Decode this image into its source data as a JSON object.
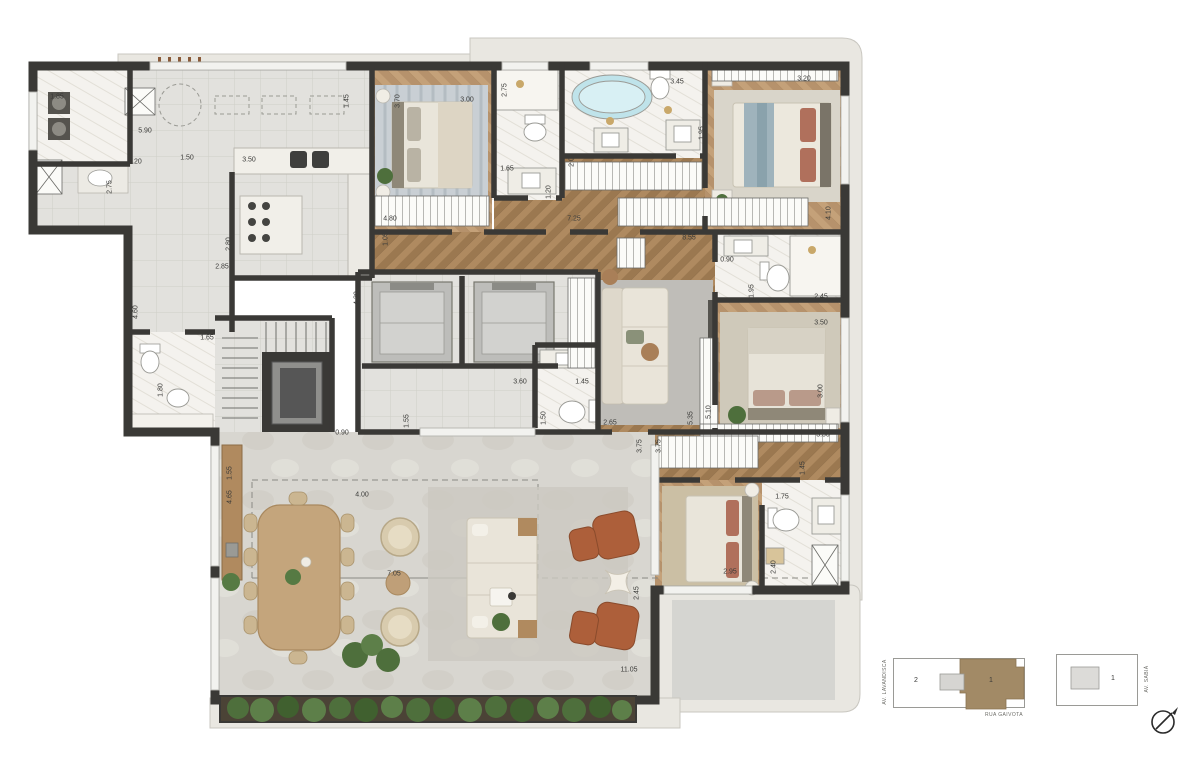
{
  "plan": {
    "dimensions": [
      {
        "x": 57,
        "y": 97,
        "v": "1.85",
        "r": 0
      },
      {
        "x": 145,
        "y": 131,
        "v": "5.90",
        "r": 0
      },
      {
        "x": 347,
        "y": 101,
        "v": "1.45",
        "r": 1
      },
      {
        "x": 135,
        "y": 162,
        "v": "1.20",
        "r": 0
      },
      {
        "x": 187,
        "y": 158,
        "v": "1.50",
        "r": 0
      },
      {
        "x": 249,
        "y": 160,
        "v": "3.50",
        "r": 0
      },
      {
        "x": 110,
        "y": 187,
        "v": "2.75",
        "r": 1
      },
      {
        "x": 229,
        "y": 244,
        "v": "2.80",
        "r": 1
      },
      {
        "x": 398,
        "y": 101,
        "v": "3.70",
        "r": 1
      },
      {
        "x": 467,
        "y": 100,
        "v": "3.00",
        "r": 0
      },
      {
        "x": 505,
        "y": 90,
        "v": "2.75",
        "r": 1
      },
      {
        "x": 677,
        "y": 82,
        "v": "3.45",
        "r": 0
      },
      {
        "x": 702,
        "y": 133,
        "v": "1.95",
        "r": 1
      },
      {
        "x": 507,
        "y": 169,
        "v": "1.65",
        "r": 0
      },
      {
        "x": 572,
        "y": 160,
        "v": "2.00",
        "r": 1
      },
      {
        "x": 549,
        "y": 192,
        "v": "1.20",
        "r": 1
      },
      {
        "x": 574,
        "y": 219,
        "v": "7.25",
        "r": 0
      },
      {
        "x": 390,
        "y": 219,
        "v": "4.80",
        "r": 0
      },
      {
        "x": 386,
        "y": 239,
        "v": "1.05",
        "r": 1
      },
      {
        "x": 689,
        "y": 238,
        "v": "8.55",
        "r": 0
      },
      {
        "x": 804,
        "y": 79,
        "v": "3.20",
        "r": 0
      },
      {
        "x": 829,
        "y": 213,
        "v": "4.10",
        "r": 1
      },
      {
        "x": 727,
        "y": 260,
        "v": "0.90",
        "r": 0
      },
      {
        "x": 752,
        "y": 291,
        "v": "1.95",
        "r": 1
      },
      {
        "x": 821,
        "y": 297,
        "v": "2.45",
        "r": 0
      },
      {
        "x": 821,
        "y": 323,
        "v": "3.50",
        "r": 0
      },
      {
        "x": 821,
        "y": 391,
        "v": "3.00",
        "r": 1
      },
      {
        "x": 709,
        "y": 412,
        "v": "5.10",
        "r": 1
      },
      {
        "x": 691,
        "y": 418,
        "v": "5.35",
        "r": 1
      },
      {
        "x": 823,
        "y": 435,
        "v": "3.50",
        "r": 0
      },
      {
        "x": 520,
        "y": 382,
        "v": "3.60",
        "r": 0
      },
      {
        "x": 582,
        "y": 382,
        "v": "1.45",
        "r": 0
      },
      {
        "x": 407,
        "y": 421,
        "v": "1.55",
        "r": 1
      },
      {
        "x": 544,
        "y": 418,
        "v": "1.50",
        "r": 1
      },
      {
        "x": 610,
        "y": 423,
        "v": "2.65",
        "r": 0
      },
      {
        "x": 640,
        "y": 446,
        "v": "3.75",
        "r": 1
      },
      {
        "x": 659,
        "y": 446,
        "v": "3.75",
        "r": 1
      },
      {
        "x": 222,
        "y": 267,
        "v": "2.85",
        "r": 0
      },
      {
        "x": 136,
        "y": 312,
        "v": "4.60",
        "r": 1
      },
      {
        "x": 357,
        "y": 298,
        "v": "4.30",
        "r": 1
      },
      {
        "x": 207,
        "y": 338,
        "v": "1.65",
        "r": 0
      },
      {
        "x": 161,
        "y": 390,
        "v": "1.80",
        "r": 1
      },
      {
        "x": 342,
        "y": 433,
        "v": "0.90",
        "r": 0
      },
      {
        "x": 230,
        "y": 473,
        "v": "1.55",
        "r": 1
      },
      {
        "x": 230,
        "y": 497,
        "v": "4.65",
        "r": 1
      },
      {
        "x": 362,
        "y": 495,
        "v": "4.00",
        "r": 0
      },
      {
        "x": 394,
        "y": 574,
        "v": "7.05",
        "r": 0
      },
      {
        "x": 637,
        "y": 593,
        "v": "2.45",
        "r": 1
      },
      {
        "x": 629,
        "y": 670,
        "v": "11.05",
        "r": 0
      },
      {
        "x": 730,
        "y": 572,
        "v": "2.95",
        "r": 0
      },
      {
        "x": 774,
        "y": 567,
        "v": "2.40",
        "r": 1
      },
      {
        "x": 782,
        "y": 497,
        "v": "1.75",
        "r": 0
      },
      {
        "x": 803,
        "y": 468,
        "v": "1.45",
        "r": 1
      }
    ]
  },
  "keyplans": {
    "left": {
      "unit_other": "2",
      "unit_highlight": "1",
      "street_left": "AV. LAVANDISCA",
      "street_bottom": "RUA GAIVOTA"
    },
    "right": {
      "unit": "1",
      "street_right": "AV. SABIÁ"
    }
  },
  "colors": {
    "wall": "#3a3936",
    "tile": "#e2e1dd",
    "marble": "#f4f2ee",
    "wood": "#a8855e",
    "wood-light": "#bb9870",
    "terrace": "#d8d6d0",
    "slab": "#e9e7e1",
    "keyplan-accent": "#a28a66",
    "leather": "#ad5f3a",
    "green": "#567a43",
    "tub": "#bfe3ea"
  }
}
